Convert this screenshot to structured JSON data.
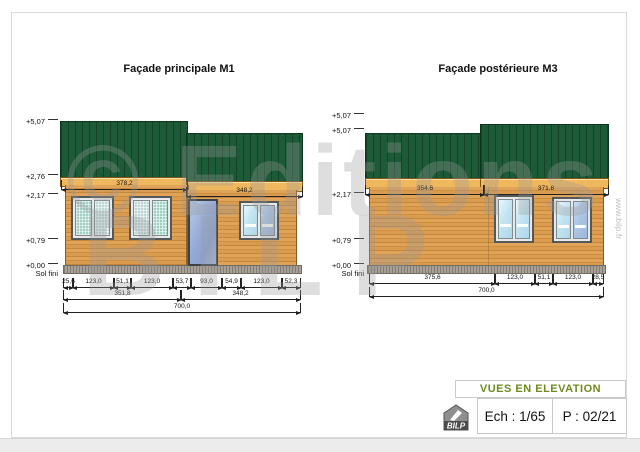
{
  "sheet": {
    "watermark_line1": "© Editions",
    "watermark_line2": "BILP",
    "watermark_vertical": "www.bilp.fr"
  },
  "facades": [
    {
      "id": "M1",
      "title": "Façade principale M1",
      "elevation_labels": [
        "+5,07",
        "+2,76",
        "+2,17",
        "+0,79",
        "+0,00",
        "Sol fini"
      ],
      "top_dims": [
        "378,2",
        "348,2"
      ],
      "segment_dims": [
        "25,6",
        "123,0",
        "51,1",
        "123,0",
        "53,7",
        "93,0",
        "54,9",
        "123,0",
        "52,3"
      ],
      "module_dims": [
        "351,8",
        "348,2"
      ],
      "total_dim": "700,0"
    },
    {
      "id": "M3",
      "title": "Façade postérieure M3",
      "elevation_labels": [
        "+5,07",
        "+5,07",
        "+2,17",
        "+0,79",
        "+0,00",
        "Sol fini"
      ],
      "top_dims": [
        "354.6",
        "371.8"
      ],
      "segment_dims": [
        "375,6",
        "123,0",
        "51,1",
        "123,0",
        "28,5"
      ],
      "total_dim": "700,0"
    }
  ],
  "title_block": {
    "title": "VUES EN ELEVATION",
    "scale_label": "Ech : 1/65",
    "page_label": "P : 02/21",
    "logo_text": "BILP"
  },
  "colors": {
    "roof_green": "#1d5a37",
    "wood": "#d69947",
    "fascia": "#f0b85e",
    "accent_green": "#6d8b1e",
    "watermark_gray": "#9a9a9a"
  }
}
